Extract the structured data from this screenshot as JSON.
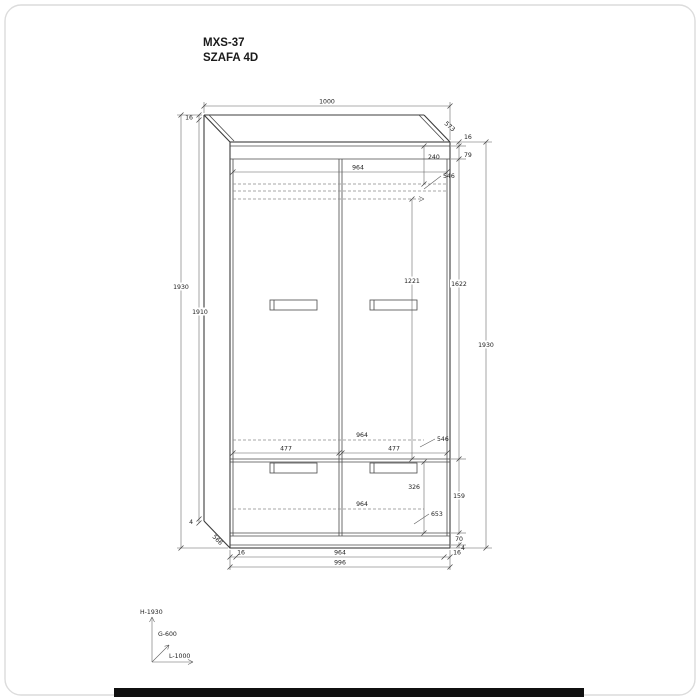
{
  "title": {
    "model": "MXS-37",
    "name": "SZAFA 4D"
  },
  "dims": {
    "top_width": "1000",
    "top_depth": "573",
    "top_thickness_left": "16",
    "height_total_left": "1930",
    "side_height": "1910",
    "bottom_gap_left": "4",
    "side_depth_bottom": "566",
    "top_thickness_right": "16",
    "top_section": "79",
    "top_shelf_drop": "240",
    "inner_width_top": "964",
    "shelf_depth_top": "546",
    "hanging_height": "1221",
    "door_height": "1622",
    "height_total_right": "1930",
    "inner_width_mid": "964",
    "shelf_depth_mid": "546",
    "door_width_left": "477",
    "door_width_right": "477",
    "drawer_front_height": "326",
    "drawer_section_height": "159",
    "inner_width_bottom": "964",
    "bottom_depth": "653",
    "plinth_height": "70",
    "bottom_gap_right": "4",
    "edge_left": "16",
    "base_inner_width": "964",
    "edge_right": "16",
    "width_total": "996"
  },
  "axes": {
    "height": "H-1930",
    "depth": "G-600",
    "length": "L-1000"
  },
  "colors": {
    "line": "#3c3c3c",
    "dimension": "#5c5c5c",
    "footer_bar": "#101010"
  }
}
